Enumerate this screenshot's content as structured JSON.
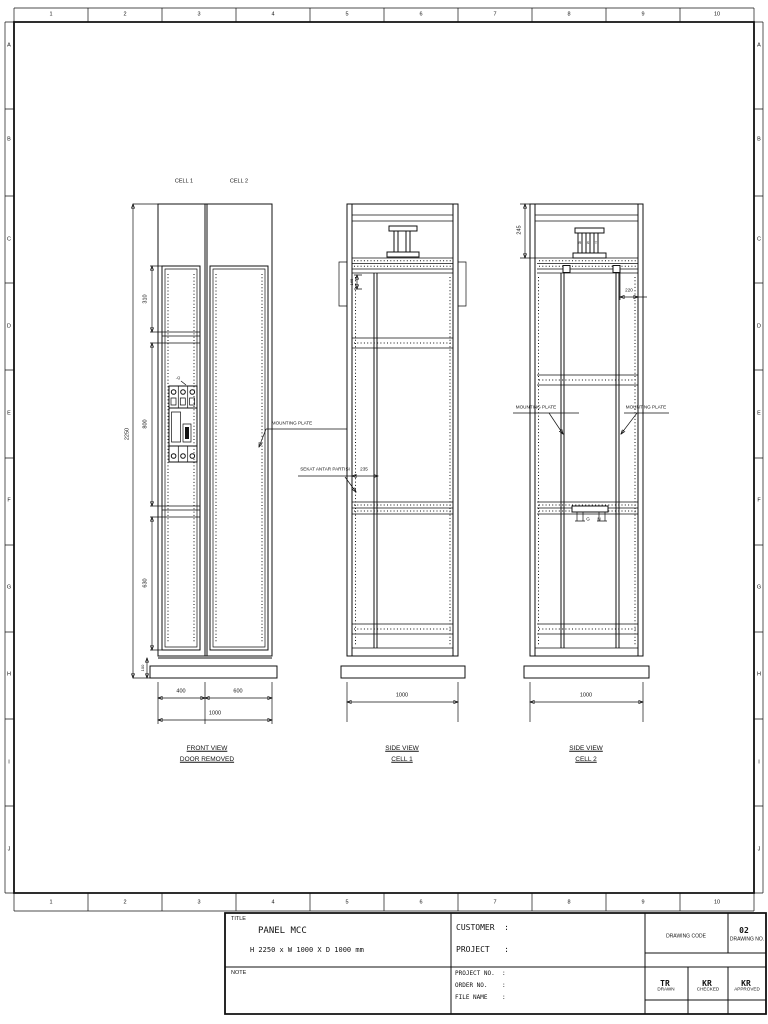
{
  "sheet": {
    "grid_cols": [
      "1",
      "2",
      "3",
      "4",
      "5",
      "6",
      "7",
      "8",
      "9",
      "10"
    ],
    "grid_rows": [
      "A",
      "B",
      "C",
      "D",
      "E",
      "F",
      "G",
      "H",
      "I",
      "J"
    ]
  },
  "front_view": {
    "cell1_label": "CELL 1",
    "cell2_label": "CELL 2",
    "dim_height": "2250",
    "dim_top": "310",
    "dim_mid": "800",
    "dim_low": "630",
    "dim_base": "100",
    "dim_w1": "400",
    "dim_w2": "600",
    "dim_w_total": "1000",
    "breaker_tag": "-Q",
    "mounting_plate_label": "MOUNTING PLATE",
    "title": "FRONT VIEW",
    "subtitle": "DOOR REMOVED"
  },
  "side_view_1": {
    "title": "SIDE VIEW",
    "subtitle": "CELL 1",
    "dim_width": "1000",
    "dim_rail": "165",
    "dim_partition": "235",
    "partition_label": "SEKAT ANTAR PARTISI"
  },
  "side_view_2": {
    "title": "SIDE VIEW",
    "subtitle": "CELL 2",
    "dim_width": "1000",
    "dim_top": "245",
    "dim_plate": "220",
    "mounting_plate_left": "MOUNTING PLATE",
    "mounting_plate_right": "MOUNTING PLATE",
    "bus_r": "R",
    "bus_s": "S",
    "bus_t": "T",
    "ground_label": "G",
    "neutral_label": "N"
  },
  "title_block": {
    "title_label": "TITLE",
    "panel_title": "PANEL MCC",
    "panel_size": "H 2250 x W 1000 X D 1000 mm",
    "note_label": "NOTE",
    "customer_label": "CUSTOMER  :",
    "project_label": "PROJECT   :",
    "project_no_label": "PROJECT NO.  :",
    "order_no_label": "ORDER NO.    :",
    "file_name_label": "FILE NAME    :",
    "drawing_code_label": "DRAWING CODE",
    "drawing_no_label": "DRAWING NO.",
    "drawing_no": "02",
    "drawn_label": "DRAWN",
    "drawn": "TR",
    "checked_label": "CHECKED",
    "checked": "KR",
    "approved_label": "APPROVED",
    "approved": "KR"
  },
  "colors": {
    "line": "#111111",
    "background": "#ffffff"
  }
}
